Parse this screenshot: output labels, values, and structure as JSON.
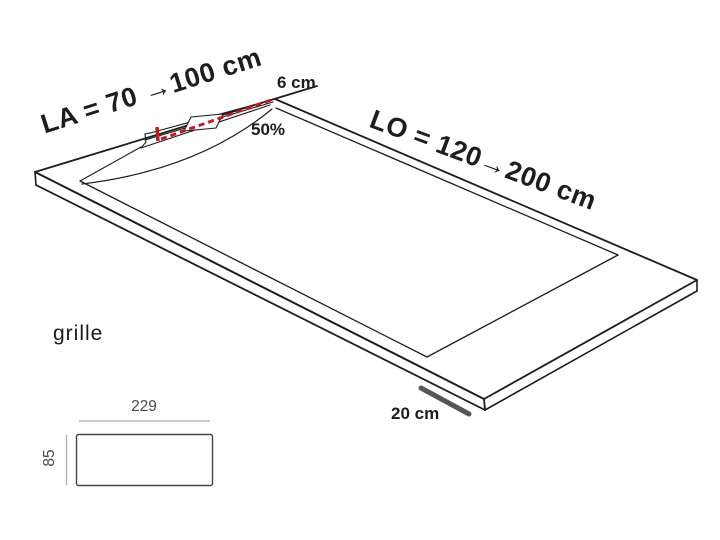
{
  "diagram": {
    "type": "shower-tray-technical-drawing",
    "tray": {
      "width_label": "LA = 70 →100 cm",
      "length_label": "LO = 120→200 cm",
      "drain_width_label": "6 cm",
      "slope_label": "50%",
      "scale_label": "20 cm"
    },
    "grille": {
      "caption": "grille",
      "width_value": "229",
      "height_value": "85"
    },
    "colors": {
      "line": "#1d1d1b",
      "drain_dash_red": "#c11b22",
      "dimension_text_gray": "#4a4a4a",
      "dimension_line_gray": "#a7abae",
      "scale_bar_gray": "#53575a",
      "background": "#ffffff"
    }
  }
}
